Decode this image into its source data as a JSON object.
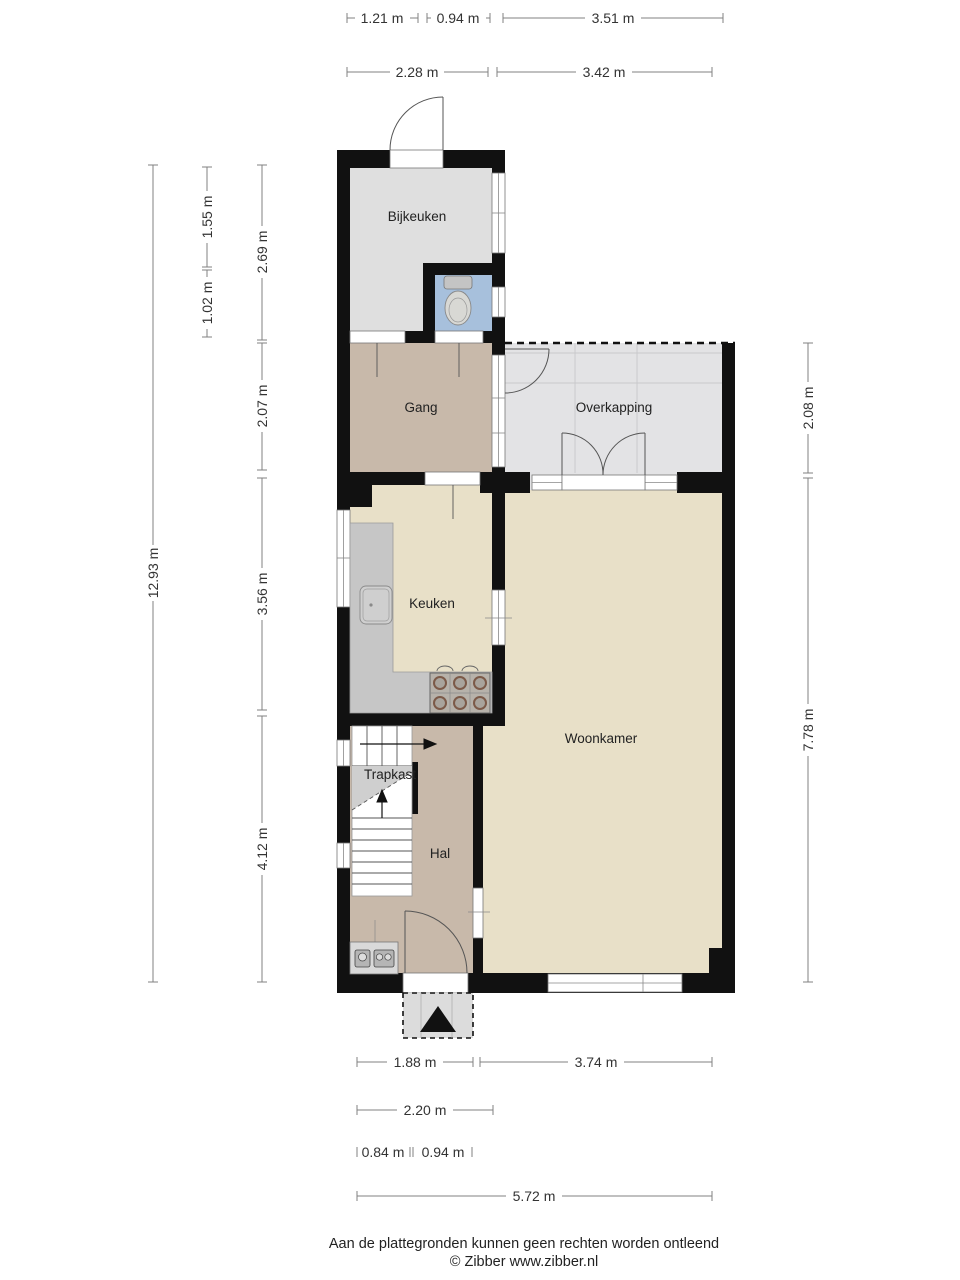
{
  "document": {
    "type": "floorplan",
    "background": "#ffffff"
  },
  "plan": {
    "rooms": [
      {
        "name": "bijkeuken",
        "label": "Bijkeuken"
      },
      {
        "name": "gang",
        "label": "Gang"
      },
      {
        "name": "overkapping",
        "label": "Overkapping"
      },
      {
        "name": "keuken",
        "label": "Keuken"
      },
      {
        "name": "woonkamer",
        "label": "Woonkamer"
      },
      {
        "name": "trapkast",
        "label": "Trapkast"
      },
      {
        "name": "hal",
        "label": "Hal"
      }
    ],
    "fixtures": [
      "toilet-icon",
      "sink-icon",
      "stove-icon",
      "stairs-icon",
      "electric-meter-icon",
      "gas-meter-icon",
      "entrance-arrow-icon"
    ],
    "colors": {
      "wall": "#111111",
      "floor_utility": "#dfdfdf",
      "floor_hall": "#c8b9aa",
      "floor_living": "#e8e0c8",
      "floor_toilet": "#a7c0dc",
      "floor_canopy": "#e3e3e5",
      "floor_porch": "#dcdcdc",
      "counter": "#c6c6c6"
    }
  },
  "dimensions": {
    "top": [
      {
        "label": "1.21 m"
      },
      {
        "label": "0.94 m"
      },
      {
        "label": "3.51 m"
      },
      {
        "label": "2.28 m"
      },
      {
        "label": "3.42 m"
      }
    ],
    "left": [
      {
        "label": "1.55 m"
      },
      {
        "label": "1.02 m"
      },
      {
        "label": "2.69 m"
      },
      {
        "label": "2.07 m"
      },
      {
        "label": "3.56 m"
      },
      {
        "label": "4.12 m"
      },
      {
        "label": "12.93 m"
      }
    ],
    "right": [
      {
        "label": "2.08 m"
      },
      {
        "label": "7.78 m"
      }
    ],
    "bottom": [
      {
        "label": "1.88 m"
      },
      {
        "label": "3.74 m"
      },
      {
        "label": "2.20 m"
      },
      {
        "label": "0.84 m"
      },
      {
        "label": "0.94 m"
      },
      {
        "label": "5.72 m"
      }
    ]
  },
  "footer": {
    "disclaimer": "Aan de plattegronden kunnen geen rechten worden ontleend",
    "copyright": "© Zibber www.zibber.nl"
  }
}
